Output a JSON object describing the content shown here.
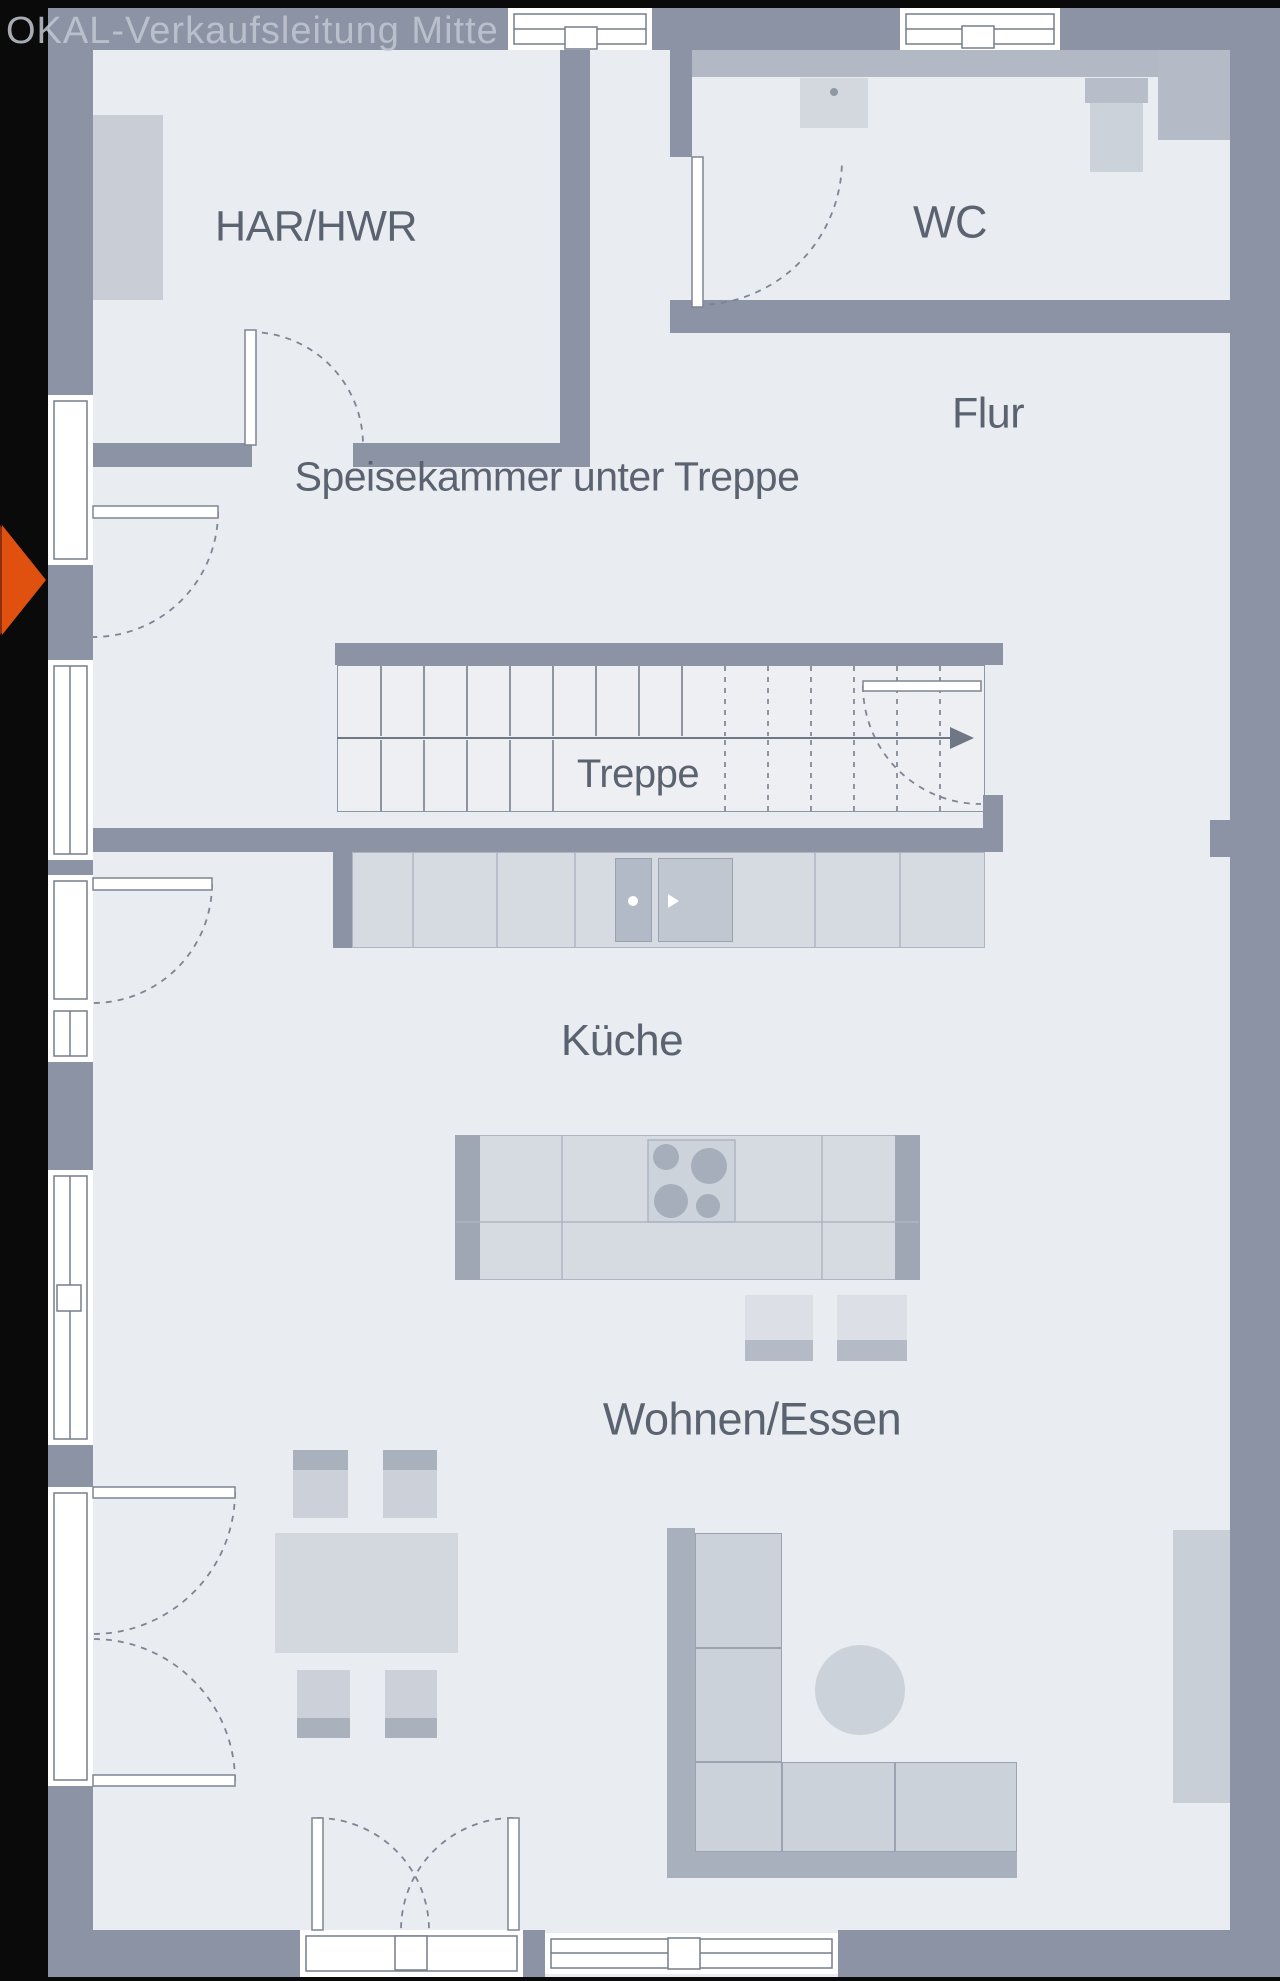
{
  "watermark": "OKAL-Verkaufsleitung Mitte",
  "labels": {
    "har_hwr": "HAR/HWR",
    "wc": "WC",
    "flur": "Flur",
    "speisekammer": "Speisekammer unter Treppe",
    "treppe": "Treppe",
    "kueche": "Küche",
    "wohnen_essen": "Wohnen/Essen"
  },
  "symbols": {
    "entrance_marker": "right-pointing-triangle",
    "stair_direction": "right-arrow"
  },
  "colors": {
    "wall": "#8b93a4",
    "floor": "#e9ecf1",
    "line": "#767e8c",
    "arc": "#7d8594",
    "furniture_light": "#d3d8df",
    "furniture_mid": "#b7bdc9",
    "accent_arrow": "#e0500f",
    "label_text": "#5b6370",
    "watermark_text": "#c3c8d2",
    "background": "#0a0a0b",
    "window_white": "#ffffff",
    "stair_floor": "#edeff3"
  }
}
